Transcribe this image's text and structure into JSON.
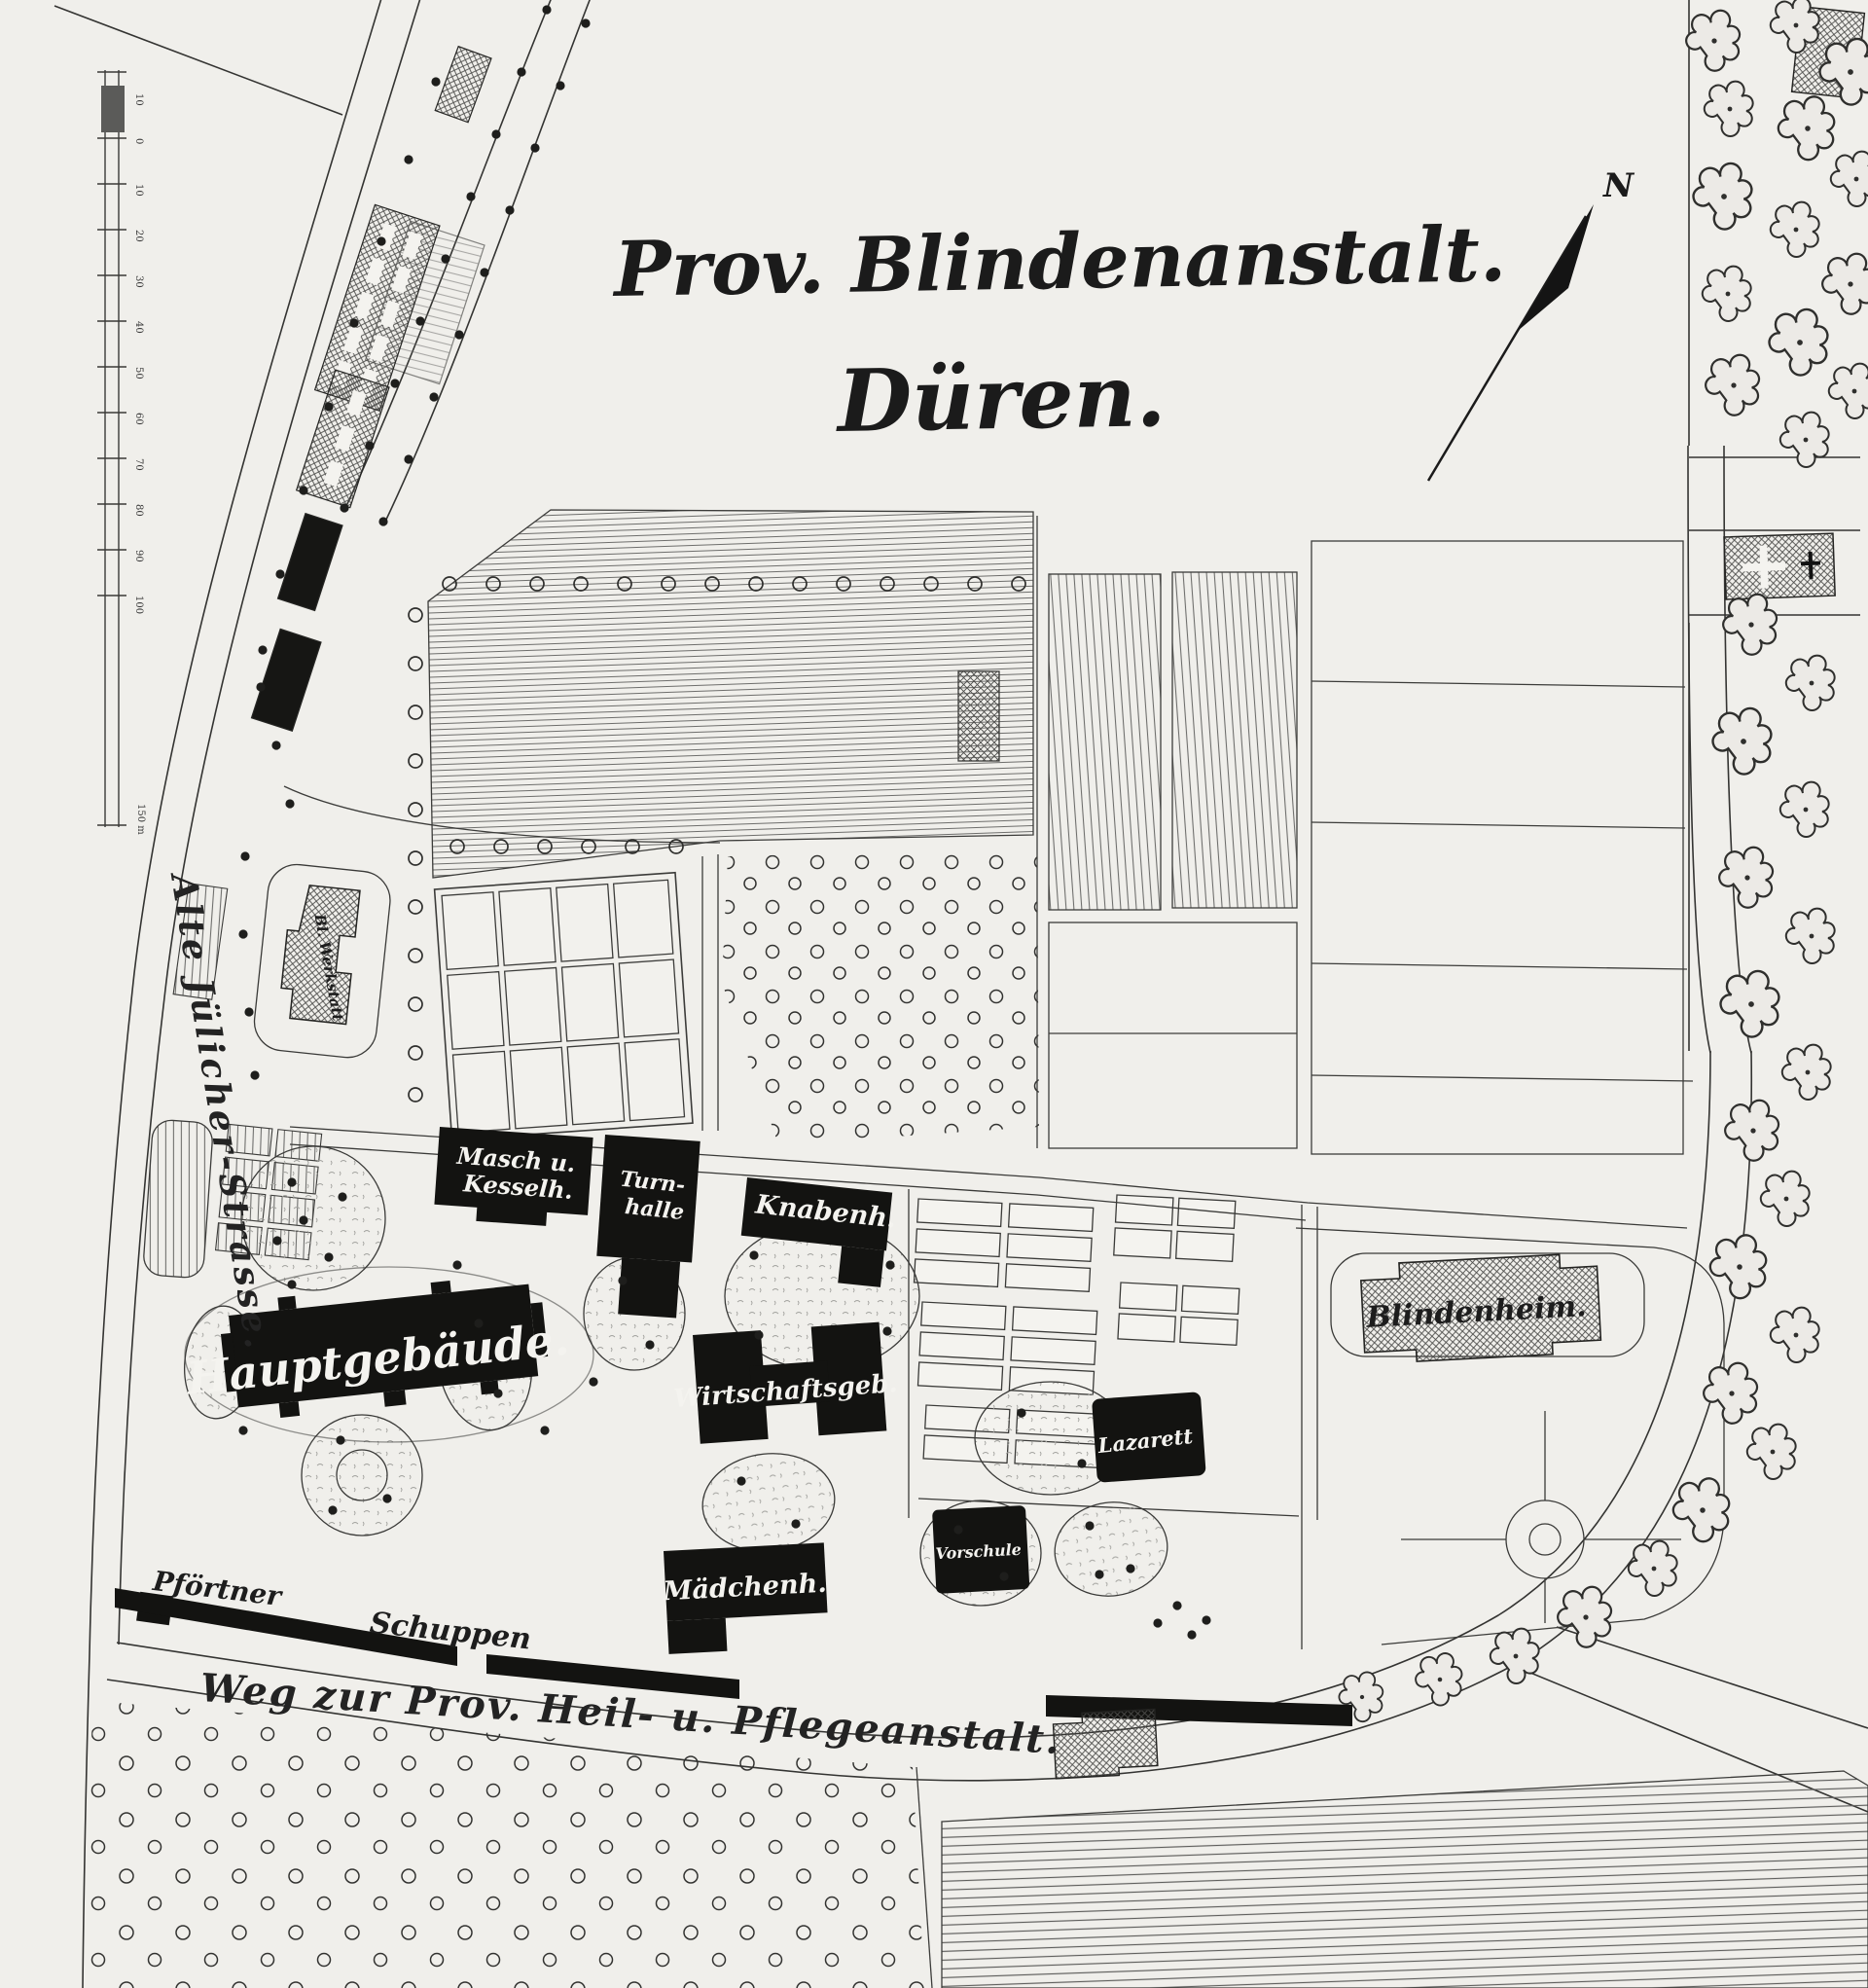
{
  "map": {
    "title_line1": "Prov. Blindenanstalt.",
    "title_line2": "Düren.",
    "compass_label": "N",
    "scale_ticks": [
      "10",
      "0",
      "10",
      "20",
      "30",
      "40",
      "50",
      "60",
      "70",
      "80",
      "90",
      "100"
    ],
    "scale_end_label": "150 m",
    "roads": {
      "left_street": "Alte Jülicher-Strasse.",
      "bottom_road": "Weg zur Prov. Heil- u. Pflegeanstalt."
    },
    "buildings": {
      "bl_werkstatt": "Bl. Werkstatt",
      "maschinen_kesselhaus_line1": "Masch u.",
      "maschinen_kesselhaus_line2": "Kesselh.",
      "turnhalle_line1": "Turn-",
      "turnhalle_line2": "halle",
      "knabenhaus": "Knabenh.",
      "hauptgebaeude": "Hauptgebäude.",
      "wirtschaftsgebaeude": "Wirtschaftsgeb.",
      "blindenheim": "Blindenheim.",
      "lazarett": "Lazarett",
      "vorschule": "Vorschule",
      "maedchenhaus": "Mädchenh.",
      "pfoertner": "Pförtner",
      "schuppen": "Schuppen"
    }
  }
}
